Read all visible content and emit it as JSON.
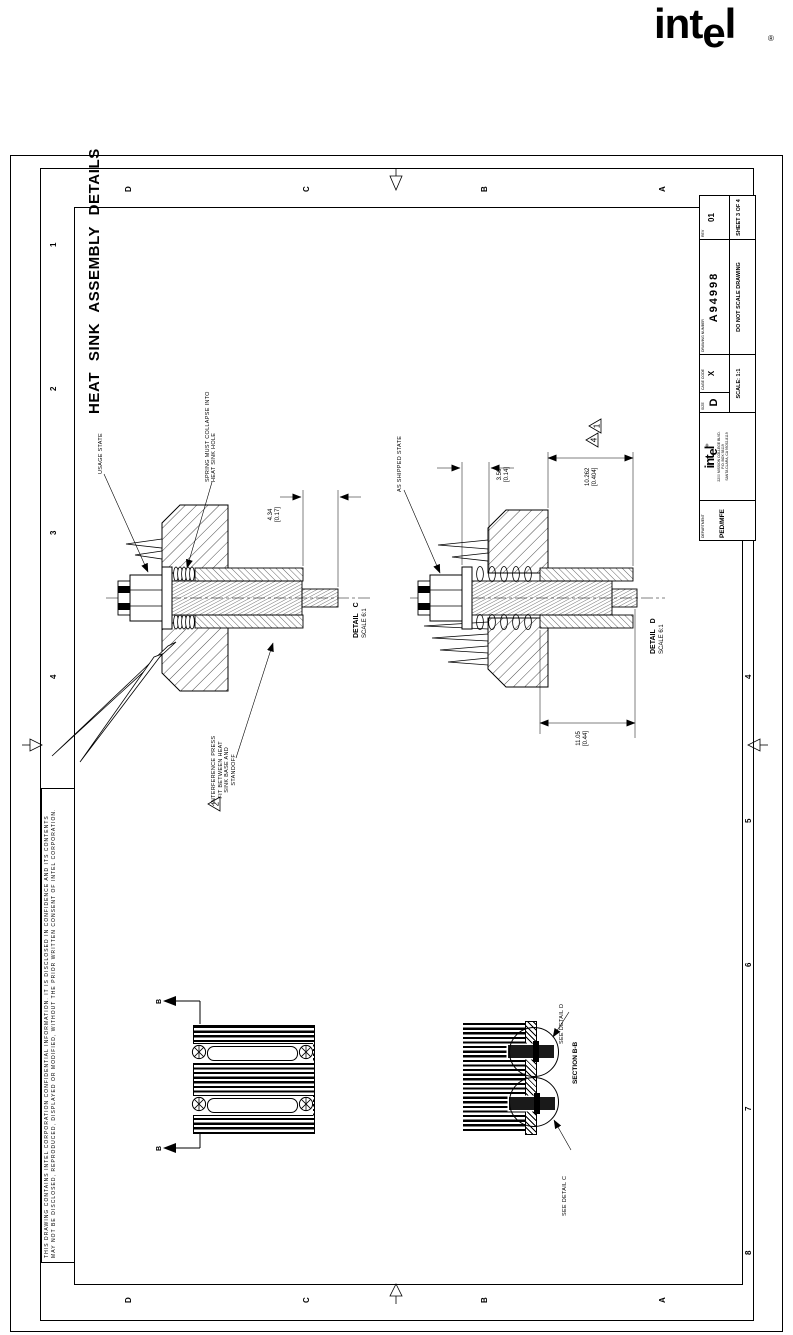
{
  "page": {
    "brand_i": "int",
    "brand_e": "e",
    "brand_l": "l",
    "registered": "®"
  },
  "frame": {
    "title": "HEAT SINK ASSEMBLY DETAILS",
    "confidential1": "THIS DRAWING CONTAINS INTEL CORPORATION CONFIDENTIAL INFORMATION. IT IS DISCLOSED IN CONFIDENCE AND ITS CONTENTS",
    "confidential2": "MAY NOT BE DISCLOSED, REPRODUCED, DISPLAYED OR MODIFIED, WITHOUT THE PRIOR WRITTEN CONSENT OF INTEL CORPORATION.",
    "zone_numbers": [
      "1",
      "2",
      "3",
      "4",
      "5",
      "6",
      "7",
      "8"
    ],
    "zone_letters": [
      "D",
      "C",
      "B",
      "A"
    ]
  },
  "title_block": {
    "department_label": "DEPARTMENT",
    "department": "PED/MFE",
    "address1": "2200 MISSION COLLEGE BLVD.",
    "address2": "P.O. BOX 58119",
    "address3": "SANTA CLARA, CA 95052-8119",
    "size_label": "SIZE",
    "size": "D",
    "cage_label": "CAGE CODE",
    "cage": "X",
    "dwg_label": "DRAWING NUMBER",
    "dwg_number": "A94998",
    "rev_label": "REV",
    "rev": "01",
    "scale": "SCALE: 1:1",
    "do_not_scale": "DO NOT SCALE DRAWING",
    "sheet": "SHEET 3 OF 4"
  },
  "detail_c": {
    "callout": "USAGE STATE",
    "spring_note1": "SPRING MUST COLLAPSE INTO",
    "spring_note2": "HEAT SINK HOLE",
    "dim_mm": "4.34",
    "dim_in": "[0.17]",
    "name": "DETAIL C",
    "scale": "SCALE 6:1",
    "flag": "2",
    "interference1": "INTERFERENCE PRESS",
    "interference2": "FIT BETWEEN HEAT",
    "interference3": "SINK BASE AND",
    "interference4": "STANDOFF"
  },
  "detail_d": {
    "callout": "AS SHIPPED STATE",
    "dim_a_mm": "3.56",
    "dim_a_in": "[0.14]",
    "dim_b_mm": "10.262",
    "dim_b_in": "[0.404]",
    "dim_c_mm": "11.05",
    "dim_c_in": "[0.44]",
    "flag1": "1",
    "flag4": "4",
    "name": "DETAIL D",
    "scale": "SCALE 6:1"
  },
  "views": {
    "cut_letter": "B",
    "see_detail_d": "SEE DETAIL D",
    "section": "SECTION B-B",
    "see_detail_c": "SEE DETAIL C"
  }
}
